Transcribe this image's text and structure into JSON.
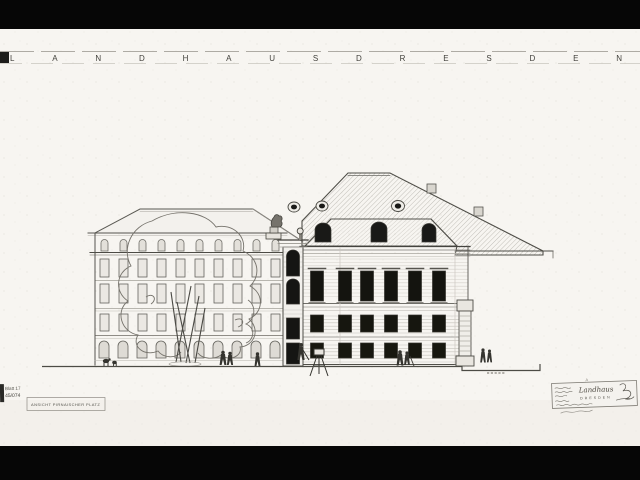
{
  "sheet": {
    "title_letters": "LANDHAUSDRESDEN",
    "archive_stamp": {
      "line1": "Blatt 17",
      "line2": "45/074"
    },
    "view_label": "ANSICHT PIRNAISCHER PLATZ",
    "title_block": {
      "mark": "A",
      "script_word": "Landhaus",
      "city": "DRESDEN"
    },
    "colors": {
      "paper": "#f7f5f1",
      "ink": "#3f3e39",
      "ink_light": "#8e8b84",
      "window": "#161614",
      "roof_hatch": "#b4b1aa",
      "letterbox": "#060606"
    }
  }
}
